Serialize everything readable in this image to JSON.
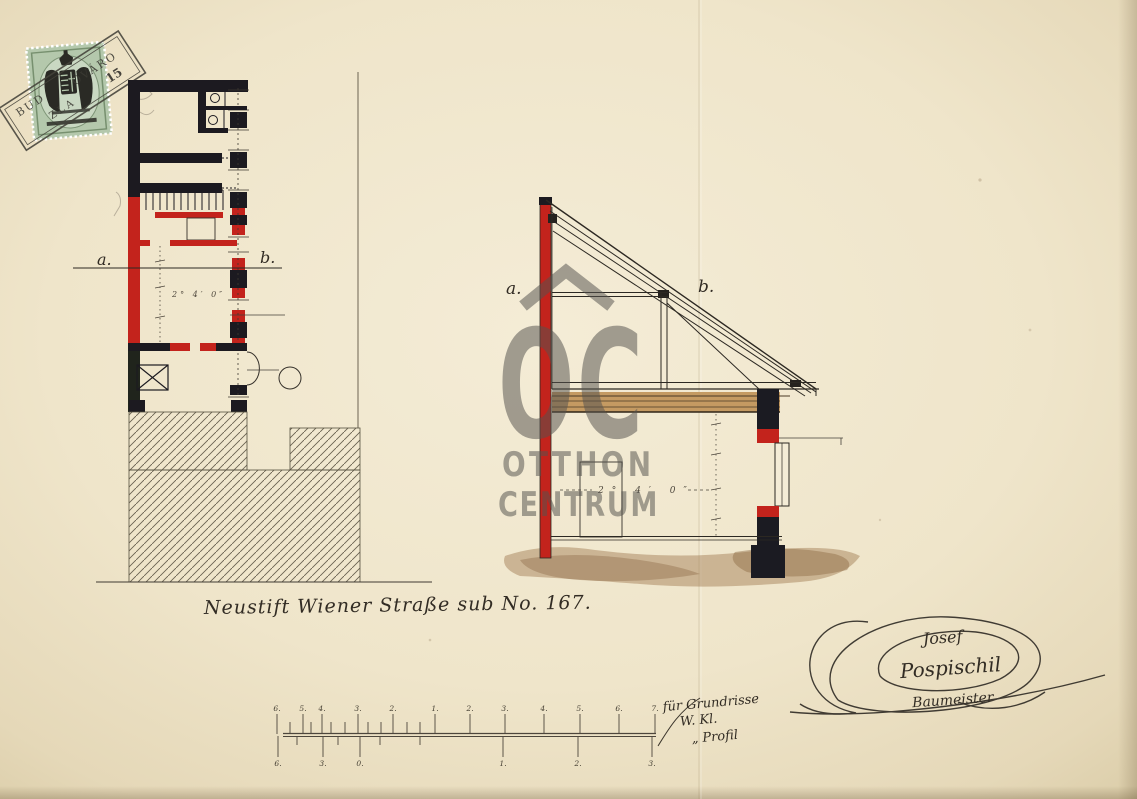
{
  "caption": {
    "text": "Neustift Wiener Straße sub No. 167."
  },
  "revenue_stamp": {
    "value": "15",
    "cancel_fragments": [
      "BUD",
      "ÓVÁRO",
      "ZLA"
    ]
  },
  "floor_plan": {
    "section_label_a": "a.",
    "section_label_b": "b.",
    "dimension": "2° 4′ 0″"
  },
  "cross_section": {
    "section_label_a": "a.",
    "section_label_b": "b.",
    "dimension": "2° 4′ 0″"
  },
  "watermark": {
    "logo": "OC",
    "line1": "OTTHON",
    "line2": "CENTRUM"
  },
  "signature": {
    "line1": "Josef",
    "line2": "Pospischil",
    "line3": "Baumeister"
  },
  "scale_bar": {
    "top_labels": [
      "6.",
      "5.",
      "4.",
      "3.",
      "2.",
      "1.",
      "2.",
      "3.",
      "4.",
      "5.",
      "6.",
      "7."
    ],
    "bottom_labels": [
      "6.",
      "3.",
      "0.",
      "1.",
      "2.",
      "3."
    ],
    "note_line1": "für Grundrisse",
    "note_line2": "W. Kl.",
    "note_line3": "„ Profil"
  },
  "colors": {
    "ink": "#1c1a20",
    "red": "#c3231c",
    "wood": "#c49a62",
    "ground": "#a5815a",
    "stamp_green": "#b4c8ac",
    "watermark_gray": "#55534f"
  }
}
